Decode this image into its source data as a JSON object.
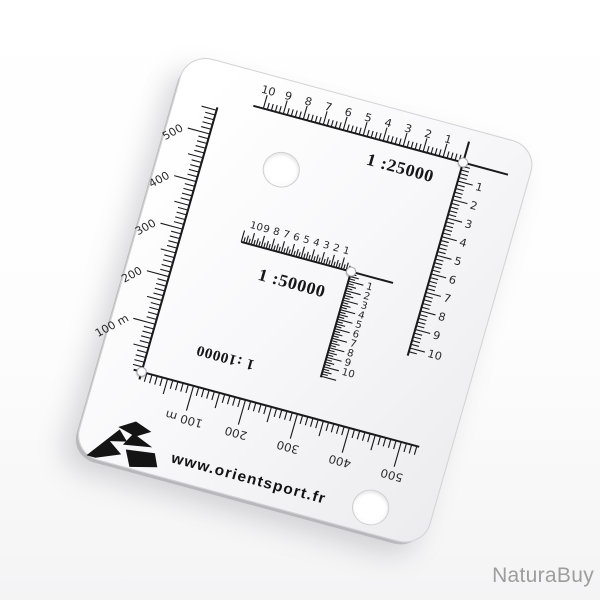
{
  "photo": {
    "background": "#ffffff"
  },
  "watermark": {
    "text": "NaturaBuy",
    "color": "#9d9d9d"
  },
  "card": {
    "ink_color": "#1a1a1c",
    "number_color": "#2a2a2c",
    "website": "www.orientsport.fr",
    "scales": {
      "map25000": {
        "ratio_label": "1 :25000",
        "unit_numbers": [
          "10",
          "9",
          "8",
          "7",
          "6",
          "5",
          "4",
          "3",
          "2",
          "1"
        ],
        "side_numbers": [
          "1",
          "2",
          "3",
          "4",
          "5",
          "6",
          "7",
          "8",
          "9",
          "10"
        ]
      },
      "map50000": {
        "ratio_label": "1 :50000",
        "unit_numbers": [
          "10",
          "9",
          "8",
          "7",
          "6",
          "5",
          "4",
          "3",
          "2",
          "1"
        ],
        "side_numbers": [
          "1",
          "2",
          "3",
          "4",
          "5",
          "6",
          "7",
          "8",
          "9",
          "10"
        ]
      },
      "map10000": {
        "ratio_label": "1 :10000",
        "left_numbers": [
          "500",
          "400",
          "300",
          "200",
          "100 m"
        ],
        "bottom_numbers": [
          "100 m",
          "200",
          "300",
          "400",
          "500"
        ]
      }
    }
  }
}
